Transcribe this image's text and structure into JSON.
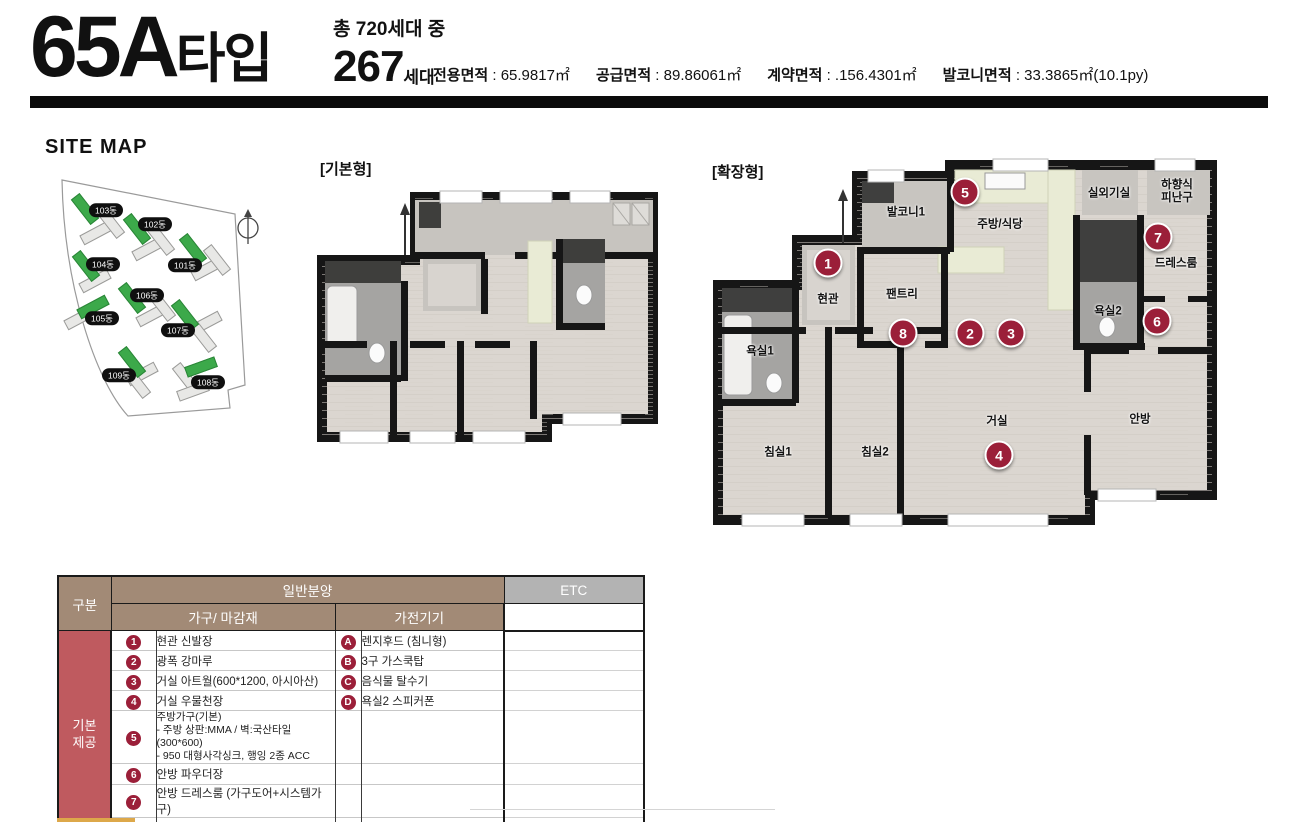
{
  "header": {
    "type_code": "65A",
    "type_suffix": "타입",
    "total_label": "총 720세대 중",
    "units_count": "267",
    "units_suffix": "세대",
    "areas": [
      {
        "label": "전용면적",
        "value": "65.9817㎡"
      },
      {
        "label": "공급면적",
        "value": "89.86061㎡"
      },
      {
        "label": "계약면적",
        "value": ".156.4301㎡"
      },
      {
        "label": "발코니면적",
        "value": "33.3865㎡(10.1py)"
      }
    ]
  },
  "site_map": {
    "title": "SITE MAP",
    "buildings": [
      {
        "name": "103동",
        "label": [
          66,
          45
        ],
        "green": {
          "x": 45,
          "y": 44,
          "a": 52
        },
        "grays": [
          {
            "x": 56,
            "y": 68,
            "a": -28
          },
          {
            "x": 71,
            "y": 58,
            "a": 52
          }
        ]
      },
      {
        "name": "102동",
        "label": [
          115,
          59
        ],
        "green": {
          "x": 97,
          "y": 64,
          "a": 52
        },
        "grays": [
          {
            "x": 108,
            "y": 84,
            "a": -28
          },
          {
            "x": 121,
            "y": 75,
            "a": 52
          }
        ]
      },
      {
        "name": "101동",
        "label": [
          145,
          100
        ],
        "green": {
          "x": 153,
          "y": 84,
          "a": 52
        },
        "grays": [
          {
            "x": 167,
            "y": 104,
            "a": -28
          },
          {
            "x": 177,
            "y": 95,
            "a": 52
          }
        ]
      },
      {
        "name": "104동",
        "label": [
          63,
          99
        ],
        "green": {
          "x": 46,
          "y": 101,
          "a": 52
        },
        "grays": [
          {
            "x": 55,
            "y": 116,
            "a": -28
          }
        ]
      },
      {
        "name": "106동",
        "label": [
          107,
          130
        ],
        "green": {
          "x": 92,
          "y": 133,
          "a": 52
        },
        "grays": [
          {
            "x": 112,
            "y": 150,
            "a": -28
          },
          {
            "x": 122,
            "y": 141,
            "a": 52
          }
        ]
      },
      {
        "name": "105동",
        "label": [
          62,
          153
        ],
        "green": {
          "x": 53,
          "y": 142,
          "a": -28
        },
        "grays": [
          {
            "x": 40,
            "y": 153,
            "a": -28
          }
        ]
      },
      {
        "name": "107동",
        "label": [
          138,
          165
        ],
        "green": {
          "x": 145,
          "y": 150,
          "a": 52
        },
        "grays": [
          {
            "x": 166,
            "y": 158,
            "a": -28
          },
          {
            "x": 163,
            "y": 172,
            "a": 52
          }
        ]
      },
      {
        "name": "109동",
        "label": [
          79,
          210
        ],
        "green": {
          "x": 92,
          "y": 197,
          "a": 52
        },
        "grays": [
          {
            "x": 102,
            "y": 209,
            "a": -28
          },
          {
            "x": 97,
            "y": 218,
            "a": 52
          }
        ]
      },
      {
        "name": "108동",
        "label": [
          168,
          217
        ],
        "green": {
          "x": 161,
          "y": 202,
          "a": -20
        },
        "grays": [
          {
            "x": 146,
            "y": 213,
            "a": 52
          },
          {
            "x": 153,
            "y": 226,
            "a": -20
          }
        ]
      }
    ]
  },
  "plans": {
    "basic_label": "[기본형]",
    "extended_label": "[확장형]",
    "extended_rooms": [
      {
        "name": "발코니1",
        "x": 196,
        "y": 58
      },
      {
        "name": "주방/식당",
        "x": 290,
        "y": 70
      },
      {
        "name": "실외기실",
        "x": 399,
        "y": 39
      },
      {
        "name": "하향식\n피난구",
        "x": 467,
        "y": 37
      },
      {
        "name": "현관",
        "x": 118,
        "y": 145
      },
      {
        "name": "팬트리",
        "x": 192,
        "y": 140
      },
      {
        "name": "드레스룸",
        "x": 466,
        "y": 109
      },
      {
        "name": "욕실2",
        "x": 398,
        "y": 157
      },
      {
        "name": "욕실1",
        "x": 50,
        "y": 197
      },
      {
        "name": "침실1",
        "x": 68,
        "y": 298
      },
      {
        "name": "침실2",
        "x": 165,
        "y": 298
      },
      {
        "name": "거실",
        "x": 287,
        "y": 267
      },
      {
        "name": "안방",
        "x": 430,
        "y": 265
      }
    ],
    "extended_markers": [
      {
        "no": "1",
        "x": 118,
        "y": 108
      },
      {
        "no": "2",
        "x": 260,
        "y": 178
      },
      {
        "no": "3",
        "x": 301,
        "y": 178
      },
      {
        "no": "4",
        "x": 289,
        "y": 300
      },
      {
        "no": "5",
        "x": 255,
        "y": 37
      },
      {
        "no": "6",
        "x": 447,
        "y": 166
      },
      {
        "no": "7",
        "x": 448,
        "y": 82
      },
      {
        "no": "8",
        "x": 193,
        "y": 178
      }
    ]
  },
  "table": {
    "gubun": "구분",
    "general": "일반분양",
    "furniture": "가구/ 마감재",
    "appliance": "가전기기",
    "etc": "ETC",
    "group": "기본\n제공",
    "rows": [
      {
        "no": "1",
        "item": "현관 신발장",
        "ano": "A",
        "atext": "렌지후드 (침니형)"
      },
      {
        "no": "2",
        "item": "광폭 강마루",
        "ano": "B",
        "atext": "3구 가스쿡탑"
      },
      {
        "no": "3",
        "item": "거실 아트월(600*1200, 아시아산)",
        "ano": "C",
        "atext": "음식물 탈수기"
      },
      {
        "no": "4",
        "item": "거실 우물천장",
        "ano": "D",
        "atext": "욕실2 스피커폰"
      },
      {
        "no": "5",
        "item": "주방가구(기본)\n- 주방 상판:MMA / 벽:국산타일(300*600)\n- 950 대형사각싱크, 행잉 2종 ACC",
        "ano": "",
        "atext": ""
      },
      {
        "no": "6",
        "item": "안방 파우더장",
        "ano": "",
        "atext": ""
      },
      {
        "no": "7",
        "item": "안방 드레스룸 (가구도어+시스템가구)",
        "ano": "",
        "atext": ""
      },
      {
        "no": "8",
        "item": "팬트리 가구도어",
        "ano": "",
        "atext": ""
      }
    ]
  },
  "colors": {
    "badge": "#9b1f39",
    "header_tan": "#a28a76",
    "etc_gray": "#b3b3b3",
    "group_red": "#bf5a5f",
    "site_green": "#3ca94a"
  }
}
